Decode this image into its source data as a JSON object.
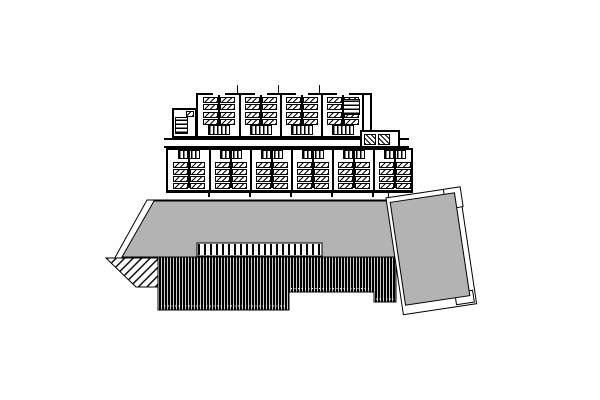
{
  "drawing": {
    "kind": "black-and-white architectural site plan: two rows of dwelling-unit floor plans above a gray roof with louver hatching and a tilted gray annex roof",
    "colors": {
      "paper": "#ffffff",
      "ink": "#000000",
      "roof_gray": "#b3b3b3"
    },
    "floor_plan": {
      "upper_row": {
        "units": 4,
        "beds_per_side": 4,
        "stair_position": "bottom"
      },
      "lower_row": {
        "units": 6,
        "beds_per_side": 4,
        "stair_position": "top"
      },
      "left_annex_stair": true,
      "right_annex_rooms": 2
    },
    "roof": {
      "main_roof": "gray trapezoid with white eave outline",
      "railing_comb_strip": true,
      "louver_hatch": "black vertical bars, stepped bottom edge, white dotted seams",
      "fan_stair_bottom_left": true,
      "tilted_annex": {
        "rotation_deg": -8.5,
        "notch_top_right": true
      }
    }
  }
}
